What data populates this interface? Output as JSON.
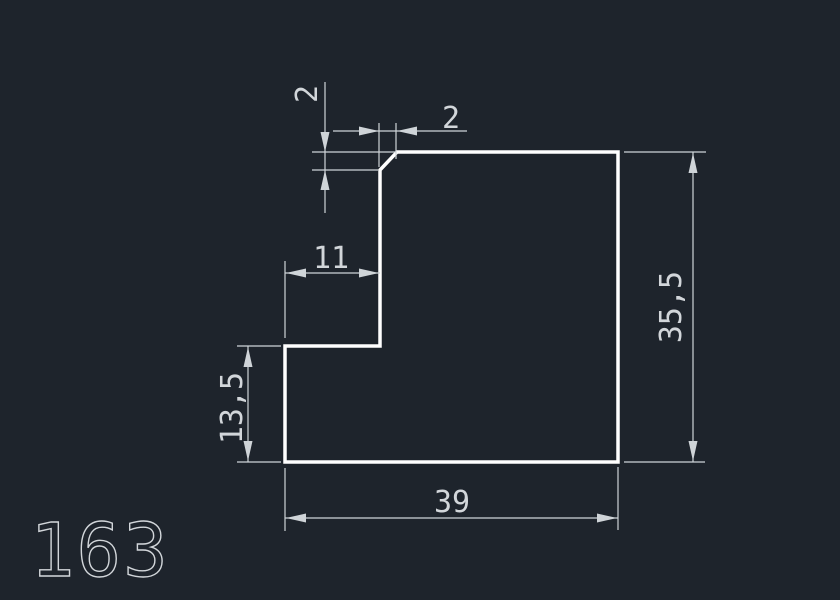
{
  "drawing": {
    "part_number": "163",
    "labels": {
      "chamfer_height": "2",
      "chamfer_width": "2",
      "step_width": "11",
      "step_height": "13,5",
      "overall_height": "35,5",
      "overall_width": "39"
    },
    "colors": {
      "background": "#1e242c",
      "outline": "#ffffff",
      "dimension_lines": "#cfd4d8",
      "text": "#d2d6da"
    }
  }
}
